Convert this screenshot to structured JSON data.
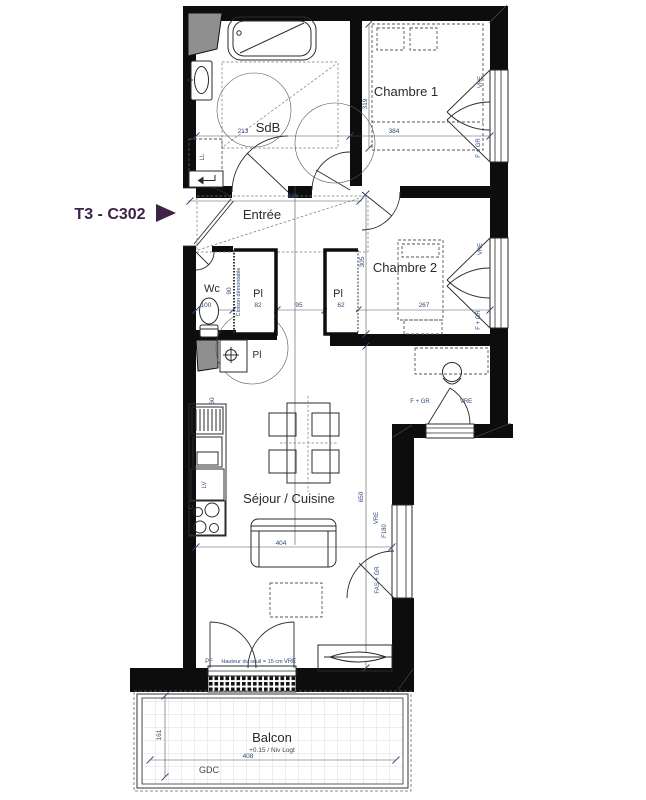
{
  "title": {
    "label": "T3 - C302"
  },
  "colors": {
    "title_accent": "#3E2347",
    "dimension_text": "#2E4A7A",
    "wall": "#0D0D0D"
  },
  "rooms": {
    "sdb": "SdB",
    "chambre1": "Chambre 1",
    "entree": "Entrée",
    "wc": "Wc",
    "chambre2": "Chambre 2",
    "sejour_cuisine": "Séjour / Cuisine",
    "balcon": "Balcon",
    "balcon_level": "+0.15 / Niv Logt"
  },
  "labels": {
    "closet": "Pl",
    "partition": "Cloison démontable",
    "washing_machine": "LL",
    "dishwasher": "LV",
    "hob": "C",
    "gdc": "GDC"
  },
  "dimensions": {
    "sdb_width": "213",
    "chambre1_width": "384",
    "chambre1_depth": "319",
    "entree_width": "326",
    "wc_width": "100",
    "wc_depth": "90",
    "placard_entree_width": "82",
    "couloir_width": "95",
    "placard_chambre2_width": "62",
    "chambre2_width": "267",
    "chambre2_depth": "305",
    "sejour_depth": "650",
    "sejour_width": "404",
    "balcon_width": "408",
    "balcon_depth": "161",
    "kitchen_depth": "60"
  },
  "openings": {
    "vre": "VRE",
    "f_gr": "F + GR",
    "fas_gr": "FAS + GR",
    "f180": "F180",
    "pf": "PF",
    "seuil_note": "Hauteur du seuil = 15 cm"
  }
}
